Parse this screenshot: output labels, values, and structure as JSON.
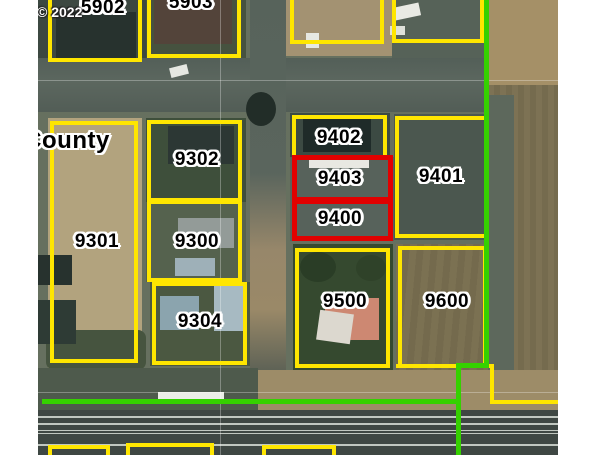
{
  "map_view": {
    "watermark": "© 2022",
    "clipped_place_label": "County",
    "line_colors": {
      "parcel_outline": "#ffe600",
      "selected_parcel_outline": "#e10000",
      "zoning_boundary": "#35d100"
    },
    "label_style": {
      "text_color": "#000000",
      "halo_color": "#ffffff"
    },
    "parcels": {
      "p5902": {
        "label": "5902",
        "outline": "yellow"
      },
      "p5903": {
        "label": "5903",
        "outline": "yellow"
      },
      "p9301": {
        "label": "9301",
        "outline": "yellow"
      },
      "p9302": {
        "label": "9302",
        "outline": "yellow"
      },
      "p9300": {
        "label": "9300",
        "outline": "yellow"
      },
      "p9304": {
        "label": "9304",
        "outline": "yellow"
      },
      "p9402": {
        "label": "9402",
        "outline": "yellow"
      },
      "p9403": {
        "label": "9403",
        "outline": "red"
      },
      "p9400": {
        "label": "9400",
        "outline": "red"
      },
      "p9401": {
        "label": "9401",
        "outline": "yellow"
      },
      "p9500": {
        "label": "9500",
        "outline": "yellow"
      },
      "p9600": {
        "label": "9600",
        "outline": "yellow"
      }
    }
  }
}
